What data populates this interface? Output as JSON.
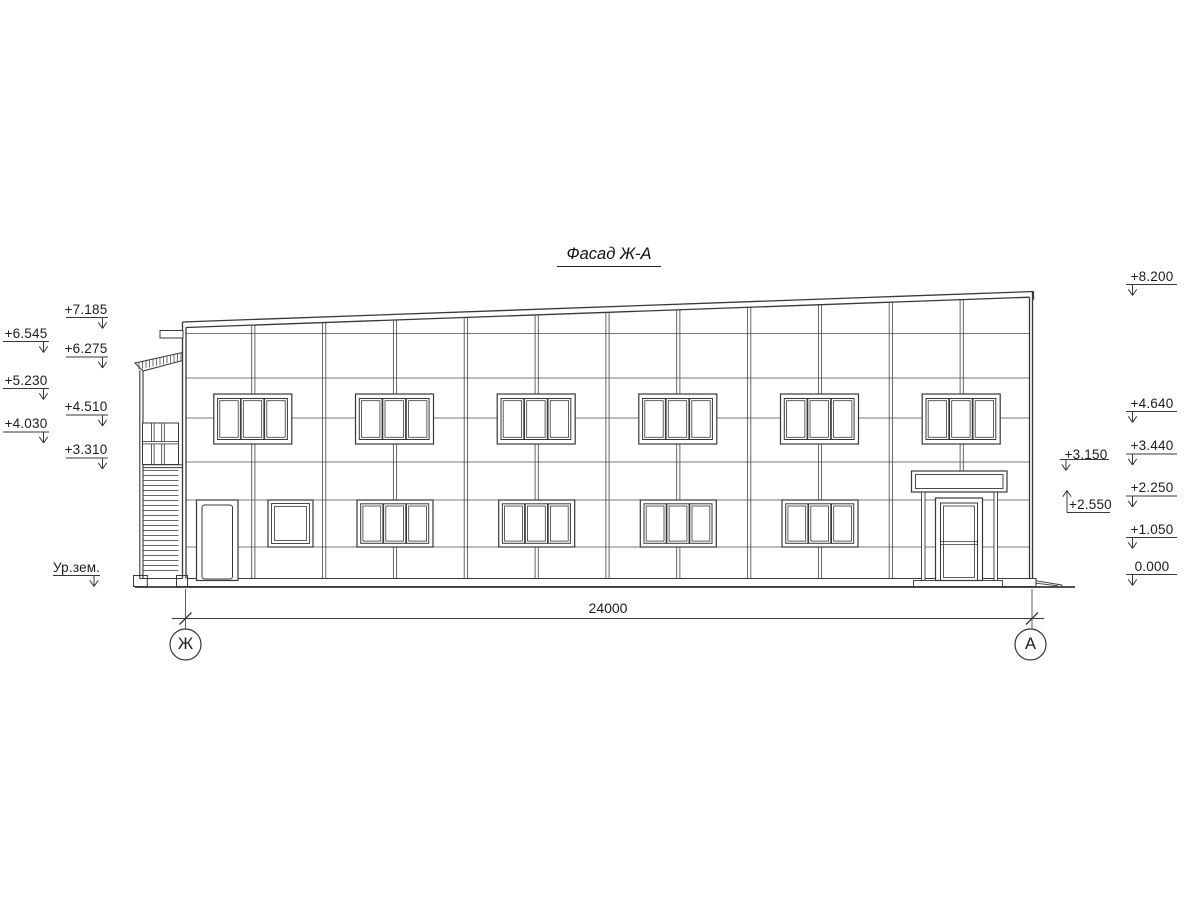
{
  "title": "Фасад Ж-А",
  "elevation_marks": {
    "left_outer": [
      "+6.545",
      "+5.230",
      "+4.030"
    ],
    "left_inner": [
      "+7.185",
      "+6.275",
      "+4.510",
      "+3.310"
    ],
    "ground_label": "Ур.зем.",
    "right": [
      "+8.200",
      "+4.640",
      "+3.440",
      "+2.250",
      "+1.050",
      "0.000"
    ],
    "canopy_top": "+3.150",
    "canopy_bottom": "+2.550"
  },
  "dimension": {
    "overall_width": "24000"
  },
  "axis_labels": {
    "left": "Ж",
    "right": "А"
  },
  "colors": {
    "ink": "#383838",
    "thin_line": "#4d4d4d",
    "background": "#ffffff"
  }
}
